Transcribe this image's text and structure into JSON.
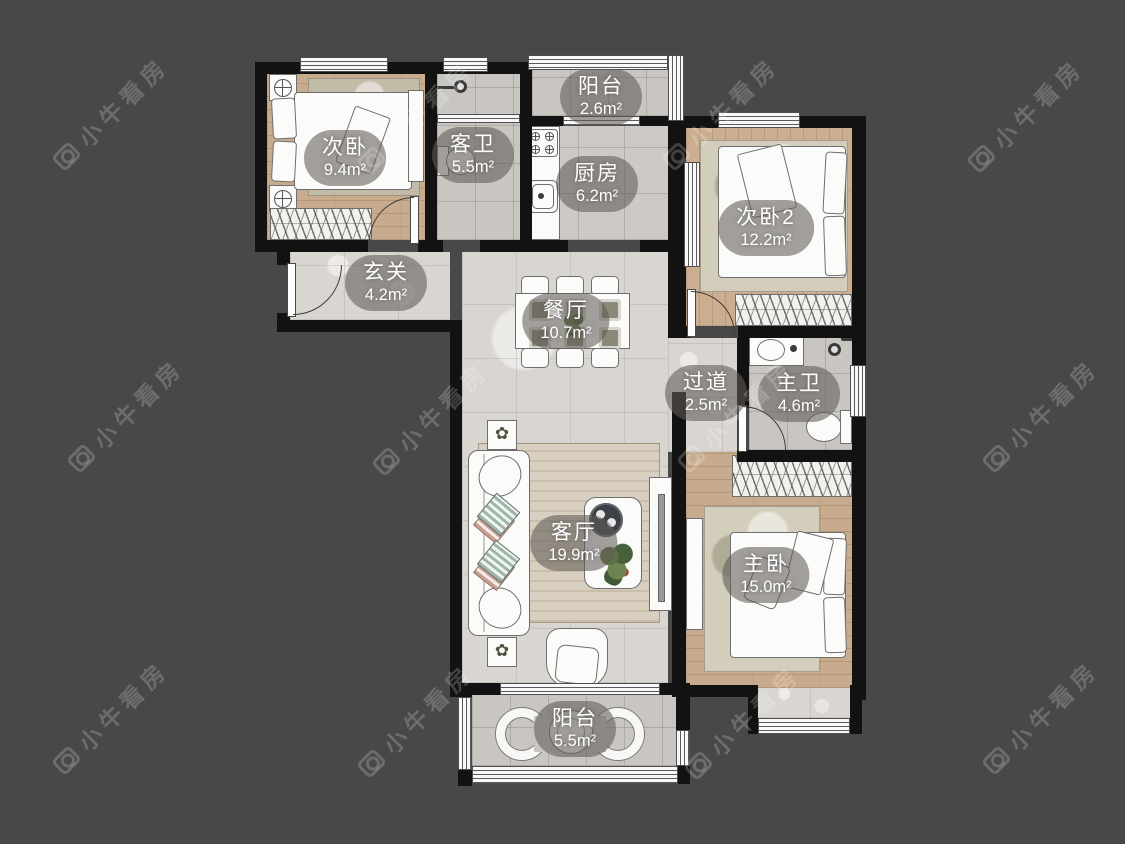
{
  "watermark": {
    "text": "小牛看房",
    "icon": "camera-logo-icon"
  },
  "colors": {
    "background": "#484848",
    "wall": "#121212",
    "label_bubble": "rgba(96,92,87,0.58)",
    "label_text": "#ffffff",
    "wood_floor": "#c8ab8c",
    "tile_floor": "#c9c6c1",
    "marble_floor": "#d9d6d1"
  },
  "rooms": [
    {
      "id": "secondary-bedroom",
      "name": "次卧",
      "area": "9.4m²"
    },
    {
      "id": "guest-bathroom",
      "name": "客卫",
      "area": "5.5m²"
    },
    {
      "id": "balcony-north",
      "name": "阳台",
      "area": "2.6m²"
    },
    {
      "id": "kitchen",
      "name": "厨房",
      "area": "6.2m²"
    },
    {
      "id": "secondary-bedroom-2",
      "name": "次卧2",
      "area": "12.2m²"
    },
    {
      "id": "foyer",
      "name": "玄关",
      "area": "4.2m²"
    },
    {
      "id": "dining-room",
      "name": "餐厅",
      "area": "10.7m²"
    },
    {
      "id": "hallway",
      "name": "过道",
      "area": "2.5m²"
    },
    {
      "id": "master-bathroom",
      "name": "主卫",
      "area": "4.6m²"
    },
    {
      "id": "living-room",
      "name": "客厅",
      "area": "19.9m²"
    },
    {
      "id": "master-bedroom",
      "name": "主卧",
      "area": "15.0m²"
    },
    {
      "id": "balcony-south",
      "name": "阳台",
      "area": "5.5m²"
    }
  ]
}
